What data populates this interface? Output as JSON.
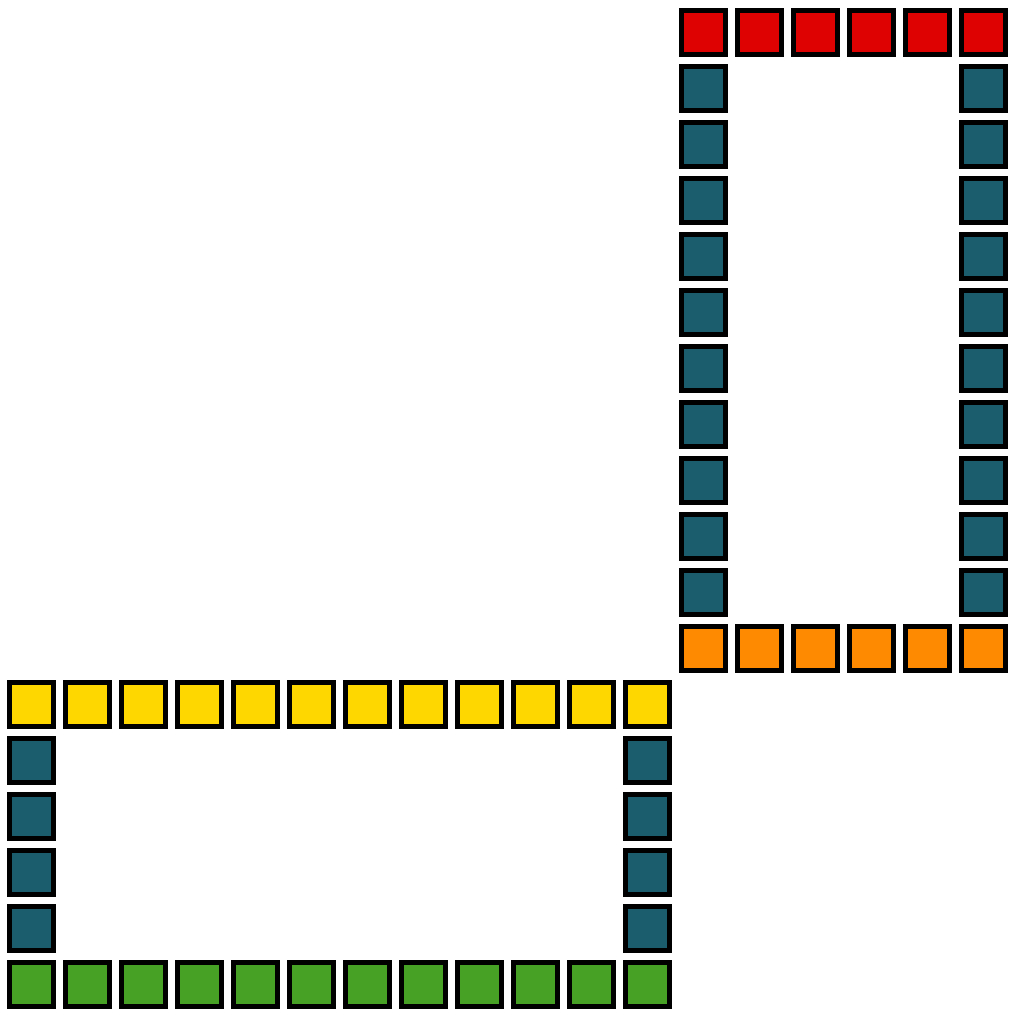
{
  "canvas": {
    "width": 1016,
    "height": 1016,
    "background_color": "#ffffff"
  },
  "palette": {
    "red": "#de0202",
    "teal": "#1b5d6d",
    "orange": "#fd8a01",
    "yellow": "#ffd700",
    "green": "#47a124",
    "outline": "#000000"
  },
  "board": {
    "grid_columns": 18,
    "grid_rows": 18,
    "frames": [
      {
        "name": "tall-frame",
        "position": "top-right",
        "origin_col": 12,
        "origin_row": 0,
        "cols": 6,
        "rows": 12,
        "top_row_color": "red",
        "bottom_row_color": "orange",
        "side_color": "teal",
        "interior": "hollow",
        "cell_counts": {
          "red": 6,
          "orange": 6,
          "teal": 20
        }
      },
      {
        "name": "wide-frame",
        "position": "bottom-left",
        "origin_col": 0,
        "origin_row": 12,
        "cols": 12,
        "rows": 6,
        "top_row_color": "yellow",
        "bottom_row_color": "green",
        "side_color": "teal",
        "interior": "hollow",
        "cell_counts": {
          "yellow": 12,
          "green": 12,
          "teal": 8
        }
      }
    ],
    "total_cells": 64
  }
}
